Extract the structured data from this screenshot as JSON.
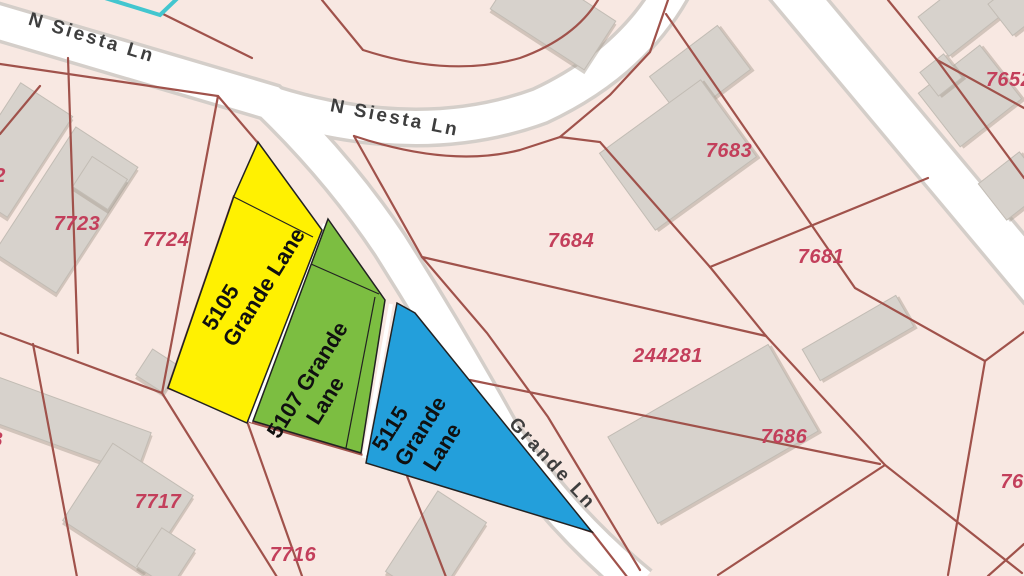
{
  "map": {
    "background_color": "#F8E8E2",
    "road_fill_color": "#FFFFFF",
    "road_casing_color": "#D4CEC9",
    "parcel_line_color": "#A0524B",
    "parcel_number_color": "#C33F5B",
    "building_color": "#D7D2CC",
    "street_label_color": "#3E3E3E",
    "selection_outline_color": "#43C6CF",
    "streets": [
      {
        "name": "N Siesta Ln"
      },
      {
        "name": "N Siesta Ln"
      },
      {
        "name": "Grande Ln"
      }
    ],
    "highlighted_lots": [
      {
        "address": "5105 Grande Lane",
        "fill_color": "#FFF101",
        "label_lines": [
          "5105",
          "Grande Lane"
        ]
      },
      {
        "address": "5107 Grande Lane",
        "fill_color": "#7CBE41",
        "label_lines": [
          "5107 Grande",
          "Lane"
        ]
      },
      {
        "address": "5115 Grande Lane",
        "fill_color": "#239FDB",
        "label_lines": [
          "5115",
          "Grande",
          "Lane"
        ]
      }
    ],
    "parcel_numbers": [
      "7723",
      "7724",
      "7683",
      "7684",
      "7681",
      "244281",
      "7686",
      "7717",
      "7716",
      "7652",
      "76",
      "2",
      "8"
    ]
  }
}
